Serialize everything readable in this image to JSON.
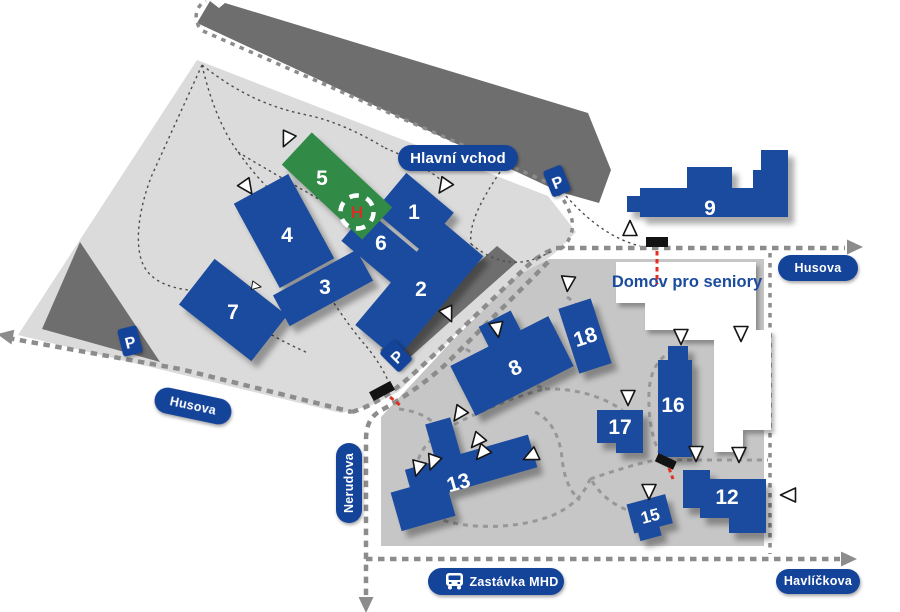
{
  "map": {
    "region_labels": {
      "main_entrance": "Hlavní vchod",
      "senior_home": "Domov pro seniory",
      "bus_stop": "Zastávka MHD"
    },
    "streets": {
      "husova_west": "Husova",
      "husova_east": "Husova",
      "nerudova": "Nerudova",
      "havlickova": "Havlíčkova"
    },
    "signs": {
      "parking": "P",
      "helipad": "H"
    },
    "buildings": [
      {
        "number": "1"
      },
      {
        "number": "2"
      },
      {
        "number": "3"
      },
      {
        "number": "4"
      },
      {
        "number": "5",
        "variant": "green-helipad"
      },
      {
        "number": "6"
      },
      {
        "number": "7"
      },
      {
        "number": "8"
      },
      {
        "number": "9"
      },
      {
        "number": "12"
      },
      {
        "number": "13"
      },
      {
        "number": "15"
      },
      {
        "number": "16"
      },
      {
        "number": "17"
      },
      {
        "number": "18"
      }
    ],
    "colors": {
      "building_blue": "#1b4b9e",
      "label_pill_blue": "#14439a",
      "helipad_green": "#318a46",
      "helipad_h_red": "#cf3327",
      "campus_upper_gray": "#dbdbdb",
      "campus_lower_gray": "#c6c6c6",
      "road_dark_gray": "#6e6e6e",
      "route_dash_gray": "#8c8c8c",
      "gate_black": "#131313",
      "gate_red": "#e03020",
      "entrance_marker": "#ffffff"
    }
  }
}
